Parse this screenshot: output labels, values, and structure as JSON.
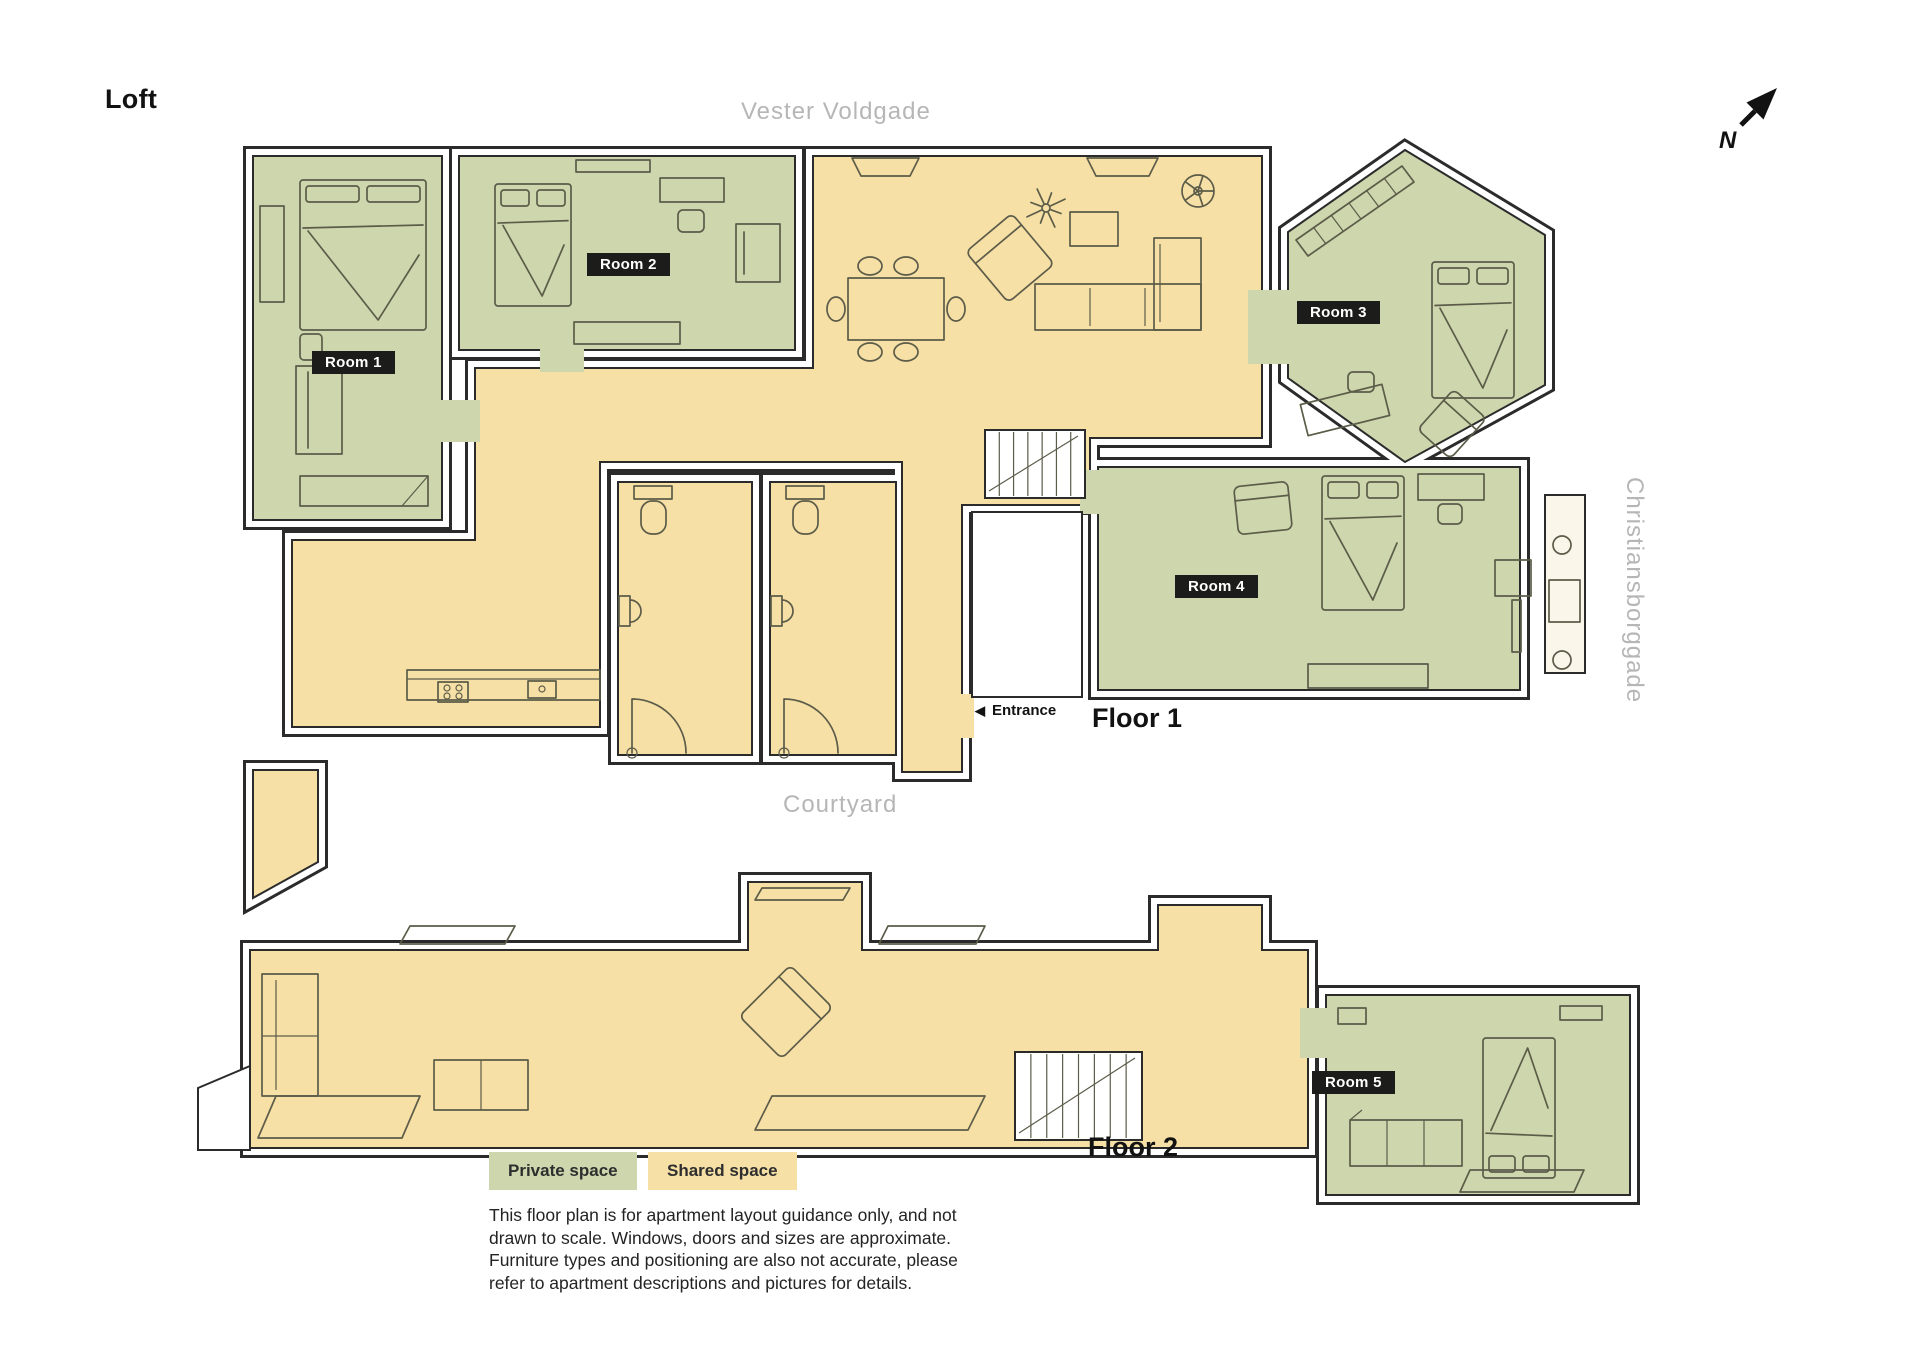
{
  "header": {
    "title": "Loft"
  },
  "streets": {
    "top": "Vester Voldgade",
    "right": "Christiansborggade",
    "courtyard": "Courtyard"
  },
  "compass": {
    "label": "N"
  },
  "rooms": [
    {
      "label": "Room 1"
    },
    {
      "label": "Room 2"
    },
    {
      "label": "Room 3"
    },
    {
      "label": "Room 4"
    },
    {
      "label": "Room 5"
    }
  ],
  "floors": [
    {
      "label": "Floor 1"
    },
    {
      "label": "Floor 2"
    }
  ],
  "entrance": {
    "arrow": "◀",
    "label": "Entrance"
  },
  "legend": {
    "private_label": "Private space",
    "shared_label": "Shared space"
  },
  "disclaimer": {
    "text": "This floor plan is for apartment layout guidance only, and not drawn to scale. Windows, doors and sizes are approximate. Furniture types and positioning are also not accurate, please refer to apartment descriptions and pictures for details."
  },
  "colors": {
    "private": "#cdd6ad",
    "shared": "#f6e0a6",
    "badge": "#1c1c1a",
    "badge_text": "#ffffff",
    "street": "#b6b6b6",
    "wall": "#2b2b2b",
    "line": "#5c5c49"
  }
}
